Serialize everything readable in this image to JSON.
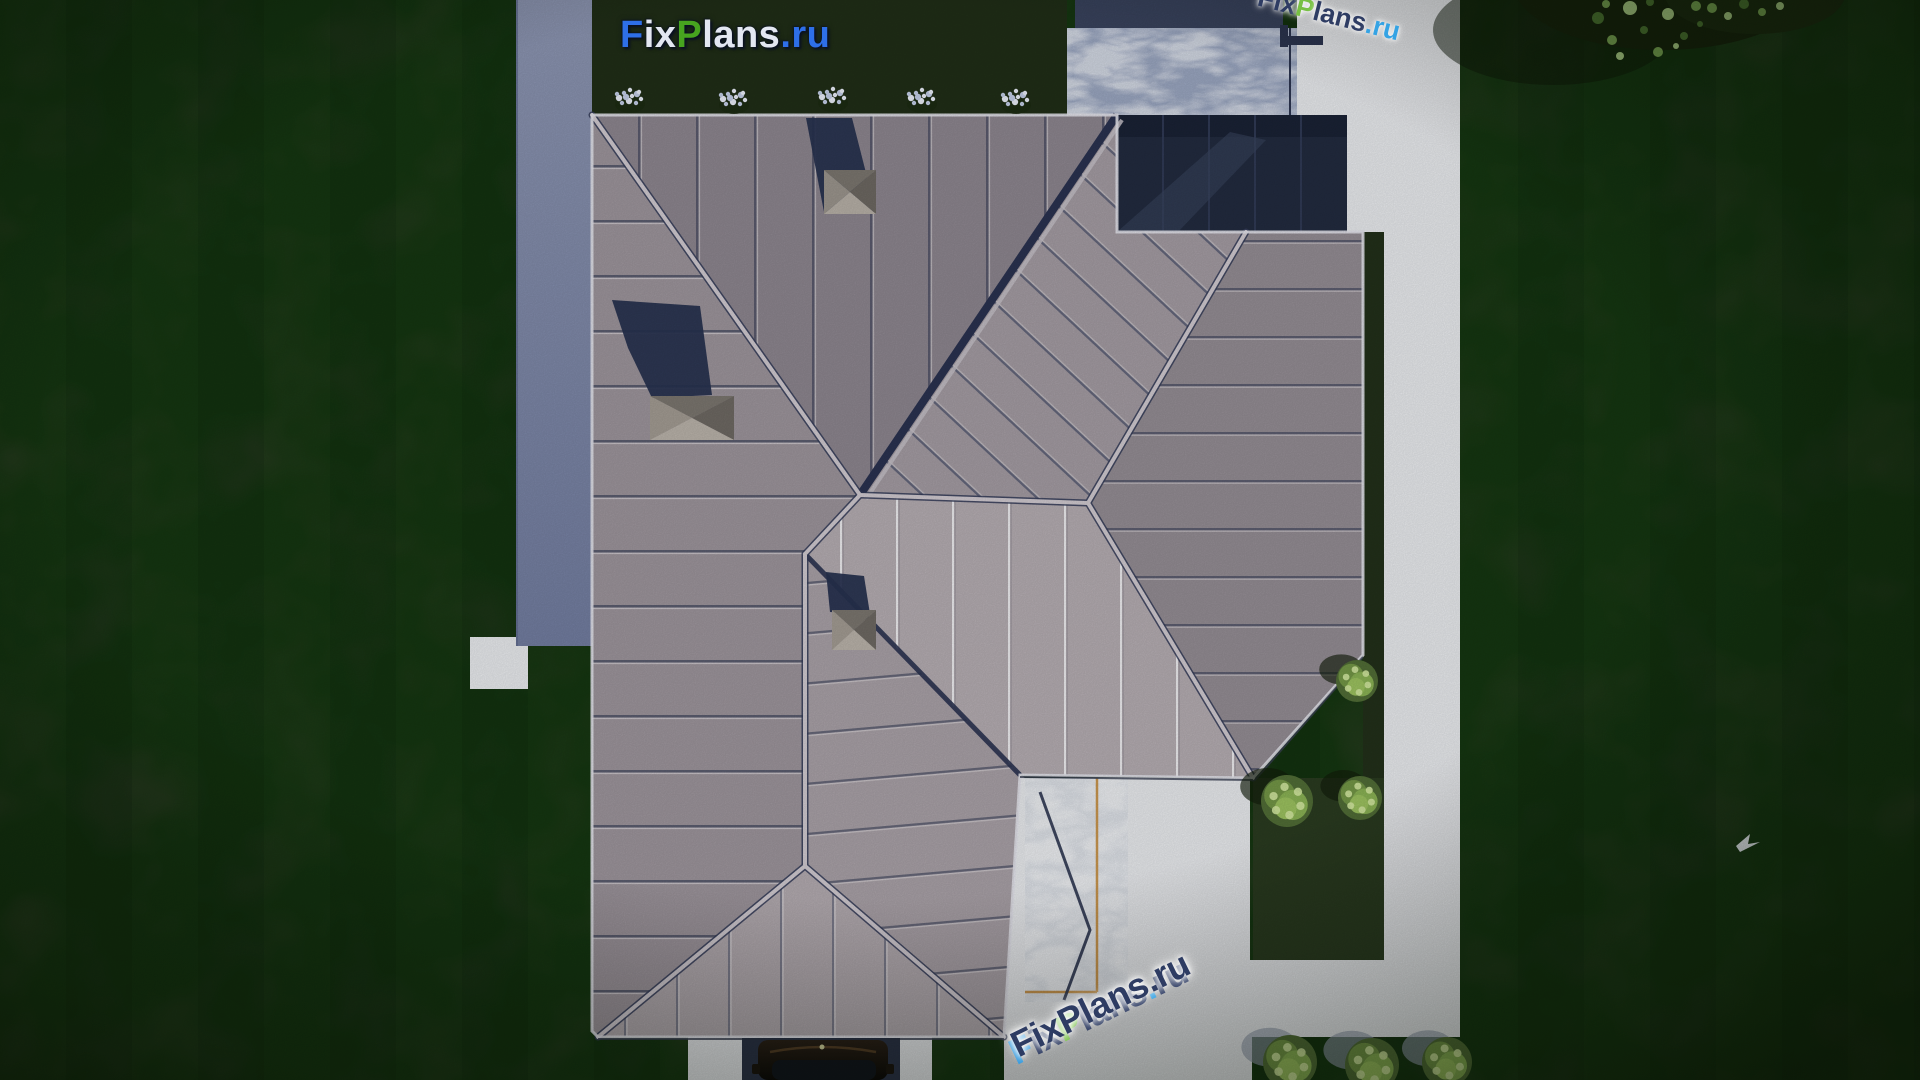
{
  "branding": {
    "logo_text": "FixPlans.ru",
    "logo_parts": [
      {
        "text": "F",
        "color": "#2e6fe8"
      },
      {
        "text": "ix",
        "color": "#e3e7f2"
      },
      {
        "text": "P",
        "color": "#47a41f"
      },
      {
        "text": "lans",
        "color": "#e3e7f2"
      },
      {
        "text": ".ru",
        "color": "#2e6fe8"
      }
    ],
    "watermark_bottom": {
      "text": "FixPlans.ru",
      "rotation_deg": -26,
      "main_color": "#2e3c63",
      "parts": [
        {
          "text": "F",
          "color": "#3399dd"
        },
        {
          "text": "ix",
          "color": "#2e3c63"
        },
        {
          "text": "P",
          "color": "#76c043"
        },
        {
          "text": "lans",
          "color": "#2e3c63"
        },
        {
          "text": ".",
          "color": "#35a3e4"
        },
        {
          "text": "ru",
          "color": "#2e3c63"
        }
      ]
    },
    "watermark_corner": {
      "text": "FixPlans.ru",
      "rotation_deg": 14,
      "parts": [
        {
          "text": "F",
          "color": "#2e3c63"
        },
        {
          "text": "ix",
          "color": "#2e3c63"
        },
        {
          "text": "P",
          "color": "#77c043"
        },
        {
          "text": "lans",
          "color": "#2e3c63"
        },
        {
          "text": ".ru",
          "color": "#35a3e4"
        }
      ]
    }
  },
  "palette": {
    "grass_a": "#2c3d23",
    "grass_b": "#273620",
    "grass_bed": "#202e17",
    "grass_shade": "#22301a",
    "grass_inset": "#2a3b20",
    "concrete": "#e9ebee",
    "stone_top": "#9aa6c0",
    "stone_stairs": "#dde1e7",
    "wall_strip": "#8d96b2",
    "roof_west": "#9d959c",
    "roof_north": "#8d868f",
    "roof_upper_right": "#a49ca3",
    "roof_east": "#948d94",
    "roof_south_light": "#b5adb2",
    "roof_lower_east": "#a9a1a7",
    "roof_lower_south": "#b3abb0",
    "garage_roof": "#222b3f",
    "pergola": "#39435d",
    "ridge_cap": "#d0cad0",
    "valley": "#2a3250",
    "navy_line": "#2c3550",
    "orange_trim": "#c9964f",
    "chimney_shadow": "#27324f",
    "bush_base": "#516d36",
    "bush_mid": "#8ab254",
    "bush_light": "#d3e8a0",
    "bush_shadow_pavement": "#97a0b0",
    "bush_shadow_grass": "#131d0b",
    "flower_white": "#e9edf8",
    "flower_blue": "#c2cde6",
    "car_slab": "#2b3347",
    "car_body_dark": "#0c0a08",
    "car_body_brown": "#2a2017",
    "bird_white": "#e8edf2",
    "tree_dark": "#16230c",
    "tree_leaf": "#7fae57"
  },
  "scene": {
    "description": "Top-down aerial 3D render of a house with a gray standing-seam hip roof, striped dark lawn, white concrete paths, stone patio, stair strip with orange trim, bushes, flower bed, car at driveway, bird over lawn, tree canopy top-right",
    "bushes": [
      {
        "x": 1357,
        "y": 681,
        "r": 21,
        "on": "grass"
      },
      {
        "x": 1287,
        "y": 801,
        "r": 26,
        "on": "grass"
      },
      {
        "x": 1360,
        "y": 798,
        "r": 22,
        "on": "grass"
      },
      {
        "x": 1290,
        "y": 1062,
        "r": 27,
        "on": "pavement"
      },
      {
        "x": 1372,
        "y": 1065,
        "r": 27,
        "on": "pavement"
      },
      {
        "x": 1447,
        "y": 1062,
        "r": 25,
        "on": "pavement"
      }
    ],
    "flowers": [
      {
        "x": 630,
        "y": 100
      },
      {
        "x": 734,
        "y": 101
      },
      {
        "x": 833,
        "y": 99
      },
      {
        "x": 922,
        "y": 100
      },
      {
        "x": 1016,
        "y": 101
      }
    ],
    "chimneys": [
      {
        "cx": 850,
        "cy": 192
      },
      {
        "cx": 692,
        "cy": 418
      },
      {
        "cx": 854,
        "cy": 630
      }
    ],
    "bird": {
      "x": 1747,
      "y": 842
    },
    "car": {
      "x": 822,
      "y": 1060
    },
    "tree": {
      "x": 1680,
      "y": 10
    }
  }
}
